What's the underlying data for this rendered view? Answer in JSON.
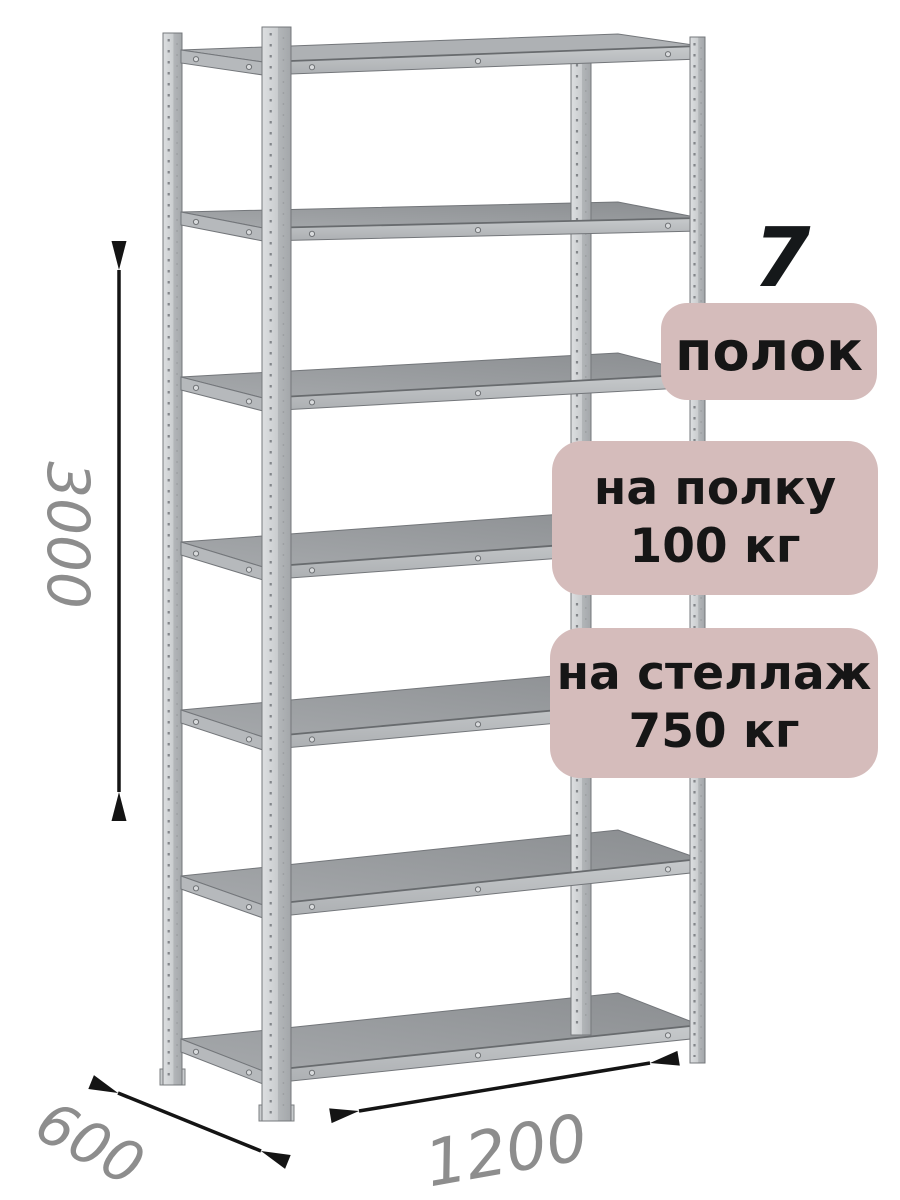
{
  "rack": {
    "shelf_count": 7
  },
  "dimensions": {
    "height": "3000",
    "depth": "600",
    "width": "1200"
  },
  "callouts": {
    "shelf_count": "7",
    "shelf_count_label": "полок",
    "per_shelf": {
      "line1": "на полку",
      "line2": "100 кг"
    },
    "per_rack": {
      "line1": "на стеллаж",
      "line2": "750 кг"
    }
  },
  "colors": {
    "background": "#ffffff",
    "badge_bg": "#d5bcbb",
    "badge_text": "#161616",
    "big_number": "#15181a",
    "dimension_text": "#8d8d8d",
    "arrow": "#141414",
    "metal_light": "#d2d4d6",
    "metal_mid": "#9a9da0",
    "metal_dark": "#6e7174"
  }
}
